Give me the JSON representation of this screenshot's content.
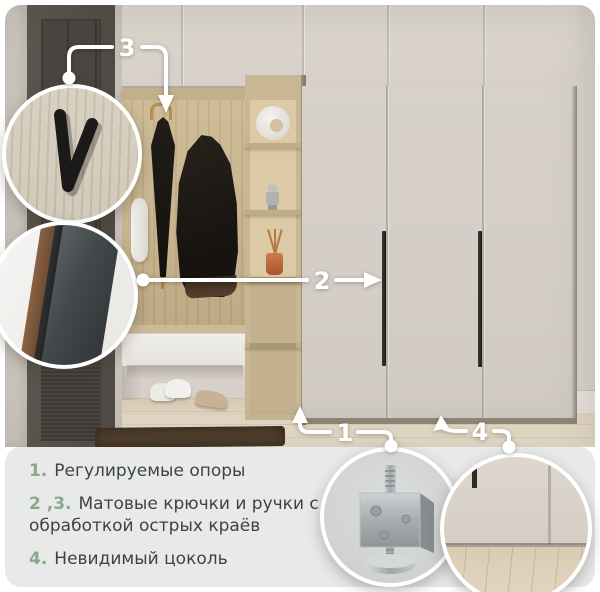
{
  "card": {
    "language": "ru",
    "kind": "furniture-feature-card"
  },
  "colors": {
    "accent_green": "#8BA88D",
    "text_dark": "#3E4342",
    "panel_bg": "#E8EAE9",
    "callout_white": "#FFFFFF",
    "wall": "#D7D1C9",
    "wardrobe_door": "#D4CEC7",
    "oak_wood": "#C9B694",
    "door_dark": "#534E49",
    "floor_wood": "#E3D8C6"
  },
  "callouts": {
    "c1": {
      "label": "1",
      "target": "adjustable-supports"
    },
    "c2": {
      "label": "2",
      "target": "wardrobe-handle"
    },
    "c3": {
      "label": "3",
      "target": "matte-hook"
    },
    "c4": {
      "label": "4",
      "target": "invisible-plinth"
    }
  },
  "legend": {
    "items": [
      {
        "num": "1.",
        "text": "Регулируемые опоры"
      },
      {
        "num": "2 ,3.",
        "text": "Матовые крючки и ручки с обработкой острых краёв"
      },
      {
        "num": "4.",
        "text": "Невидимый цоколь"
      }
    ]
  },
  "insets": {
    "hook": "matte-hook-closeup",
    "edge": "handle-edge-closeup",
    "support": "adjustable-support-closeup",
    "plinth": "invisible-plinth-closeup"
  }
}
